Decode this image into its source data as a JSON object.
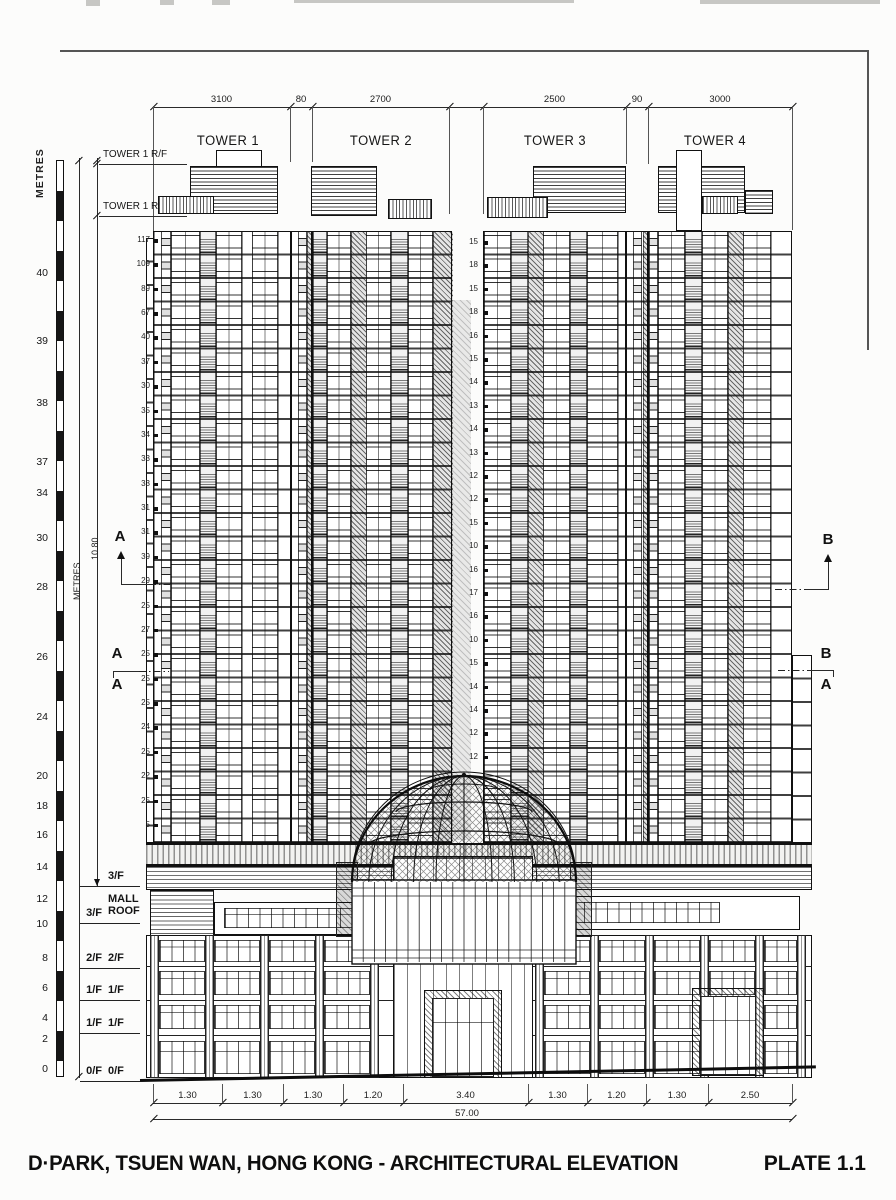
{
  "title": {
    "left": "D·PARK, TSUEN WAN, HONG KONG - ARCHITECTURAL ELEVATION",
    "right": "PLATE 1.1"
  },
  "top_dimensions": {
    "segments": [
      {
        "label": "3100",
        "x1": 153,
        "x2": 290
      },
      {
        "label": "80",
        "x1": 290,
        "x2": 312
      },
      {
        "label": "2700",
        "x1": 312,
        "x2": 449
      },
      {
        "label": "",
        "x1": 449,
        "x2": 483
      },
      {
        "label": "2500",
        "x1": 483,
        "x2": 626
      },
      {
        "label": "90",
        "x1": 626,
        "x2": 648
      },
      {
        "label": "3000",
        "x1": 648,
        "x2": 792
      }
    ],
    "drops": [
      [
        153,
        233
      ],
      [
        290,
        162
      ],
      [
        312,
        162
      ],
      [
        449,
        214
      ],
      [
        483,
        214
      ],
      [
        626,
        164
      ],
      [
        648,
        164
      ],
      [
        792,
        230
      ]
    ]
  },
  "tower_labels": [
    {
      "label": "TOWER 1",
      "cx": 228
    },
    {
      "label": "TOWER 2",
      "cx": 381
    },
    {
      "label": "TOWER 3",
      "cx": 555
    },
    {
      "label": "TOWER 4",
      "cx": 715
    }
  ],
  "roof_level_labels": [
    {
      "text": "TOWER 1 R/F",
      "y": 148,
      "line_y": 164
    },
    {
      "text": "TOWER 1 R/F",
      "y": 200,
      "line_y": 216
    }
  ],
  "metres_scale": {
    "title": "METRES",
    "marks": [
      {
        "v": "40",
        "y": 273
      },
      {
        "v": "39",
        "y": 341
      },
      {
        "v": "38",
        "y": 403
      },
      {
        "v": "37",
        "y": 462
      },
      {
        "v": "34",
        "y": 493
      },
      {
        "v": "30",
        "y": 538
      },
      {
        "v": "28",
        "y": 587
      },
      {
        "v": "26",
        "y": 657
      },
      {
        "v": "24",
        "y": 717
      },
      {
        "v": "20",
        "y": 776
      },
      {
        "v": "18",
        "y": 806
      },
      {
        "v": "16",
        "y": 835
      },
      {
        "v": "14",
        "y": 867
      },
      {
        "v": "12",
        "y": 899
      },
      {
        "v": "10",
        "y": 924
      },
      {
        "v": "8",
        "y": 958
      },
      {
        "v": "6",
        "y": 988
      },
      {
        "v": "4",
        "y": 1018
      },
      {
        "v": "2",
        "y": 1039
      },
      {
        "v": "0",
        "y": 1069
      }
    ]
  },
  "vertical_dim_labels": {
    "metres": "METRES",
    "height": "10.80"
  },
  "floor_numbers": {
    "tower1": {
      "values": [
        "117",
        "109",
        "89",
        "67",
        "40",
        "37",
        "30",
        "35",
        "34",
        "33",
        "33",
        "31",
        "31",
        "39",
        "29",
        "25",
        "27",
        "25",
        "25",
        "25",
        "24",
        "25",
        "22",
        "25",
        "5"
      ]
    },
    "tower3": {
      "values": [
        "15",
        "18",
        "15",
        "18",
        "16",
        "15",
        "14",
        "13",
        "14",
        "13",
        "12",
        "12",
        "15",
        "10",
        "16",
        "17",
        "16",
        "10",
        "15",
        "14",
        "14",
        "12",
        "12"
      ]
    }
  },
  "section_markers": {
    "left_upper": "A",
    "left_pair_top": "A",
    "left_pair_bottom": "A",
    "right_upper": "B",
    "right_pair_top": "B",
    "right_pair_bottom": "A"
  },
  "podium_levels": [
    {
      "left": "",
      "right": "3/F",
      "y": 886
    },
    {
      "left": "3/F",
      "right": "MALL ROOF",
      "y": 923
    },
    {
      "left": "2/F",
      "right": "2/F",
      "y": 968
    },
    {
      "left": "1/F",
      "right": "1/F",
      "y": 1000
    },
    {
      "left": "1/F",
      "right": "1/F",
      "y": 1033
    },
    {
      "left": "0/F",
      "right": "0/F",
      "y": 1081
    }
  ],
  "bottom_dimensions": {
    "ticks": [
      153,
      222,
      283,
      343,
      403,
      528,
      587,
      646,
      708,
      792
    ],
    "segment_labels": [
      "1.30",
      "1.30",
      "1.30",
      "1.20",
      "3.40",
      "1.30",
      "1.20",
      "1.30",
      "2.50"
    ],
    "total_label": "57.00"
  }
}
